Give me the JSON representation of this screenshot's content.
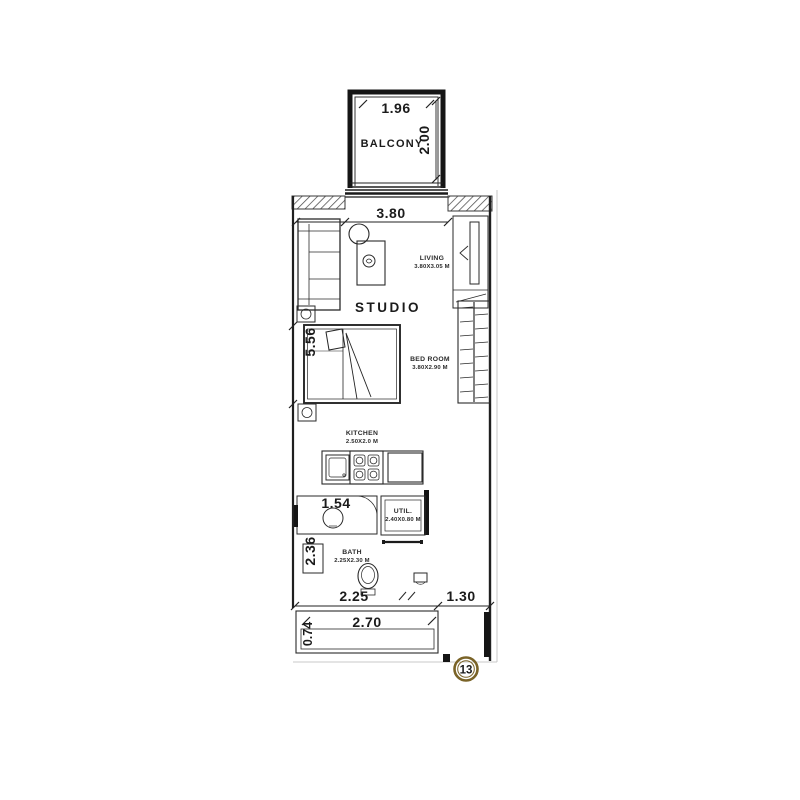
{
  "plan_title": "STUDIO",
  "colors": {
    "accent_gold": "#8a6a2a",
    "badge_gold": "#7a6327",
    "line_dark": "#1b1b1b"
  },
  "balcony": {
    "label": "BALCONY",
    "width_dim": "1.96",
    "depth_dim": "2.00"
  },
  "living": {
    "label": "LIVING",
    "size": "3.80X3.05 M",
    "width_dim": "3.80"
  },
  "bedroom": {
    "label": "BED ROOM",
    "size": "3.80X2.90 M",
    "height_dim": "5.56"
  },
  "kitchen": {
    "label": "KITCHEN",
    "size": "2.50X2.0 M"
  },
  "utility": {
    "label": "UTIL.",
    "size": "2.40X0.80 M"
  },
  "bath": {
    "label": "BATH",
    "size": "2.25X2.30 M",
    "height_dim": "2.36",
    "shower_dim": "1.54"
  },
  "bottom_dims": {
    "left": "2.25",
    "right": "1.30",
    "terrace_width": "2.70",
    "terrace_depth": "0.74"
  },
  "unit": {
    "number": "13"
  }
}
